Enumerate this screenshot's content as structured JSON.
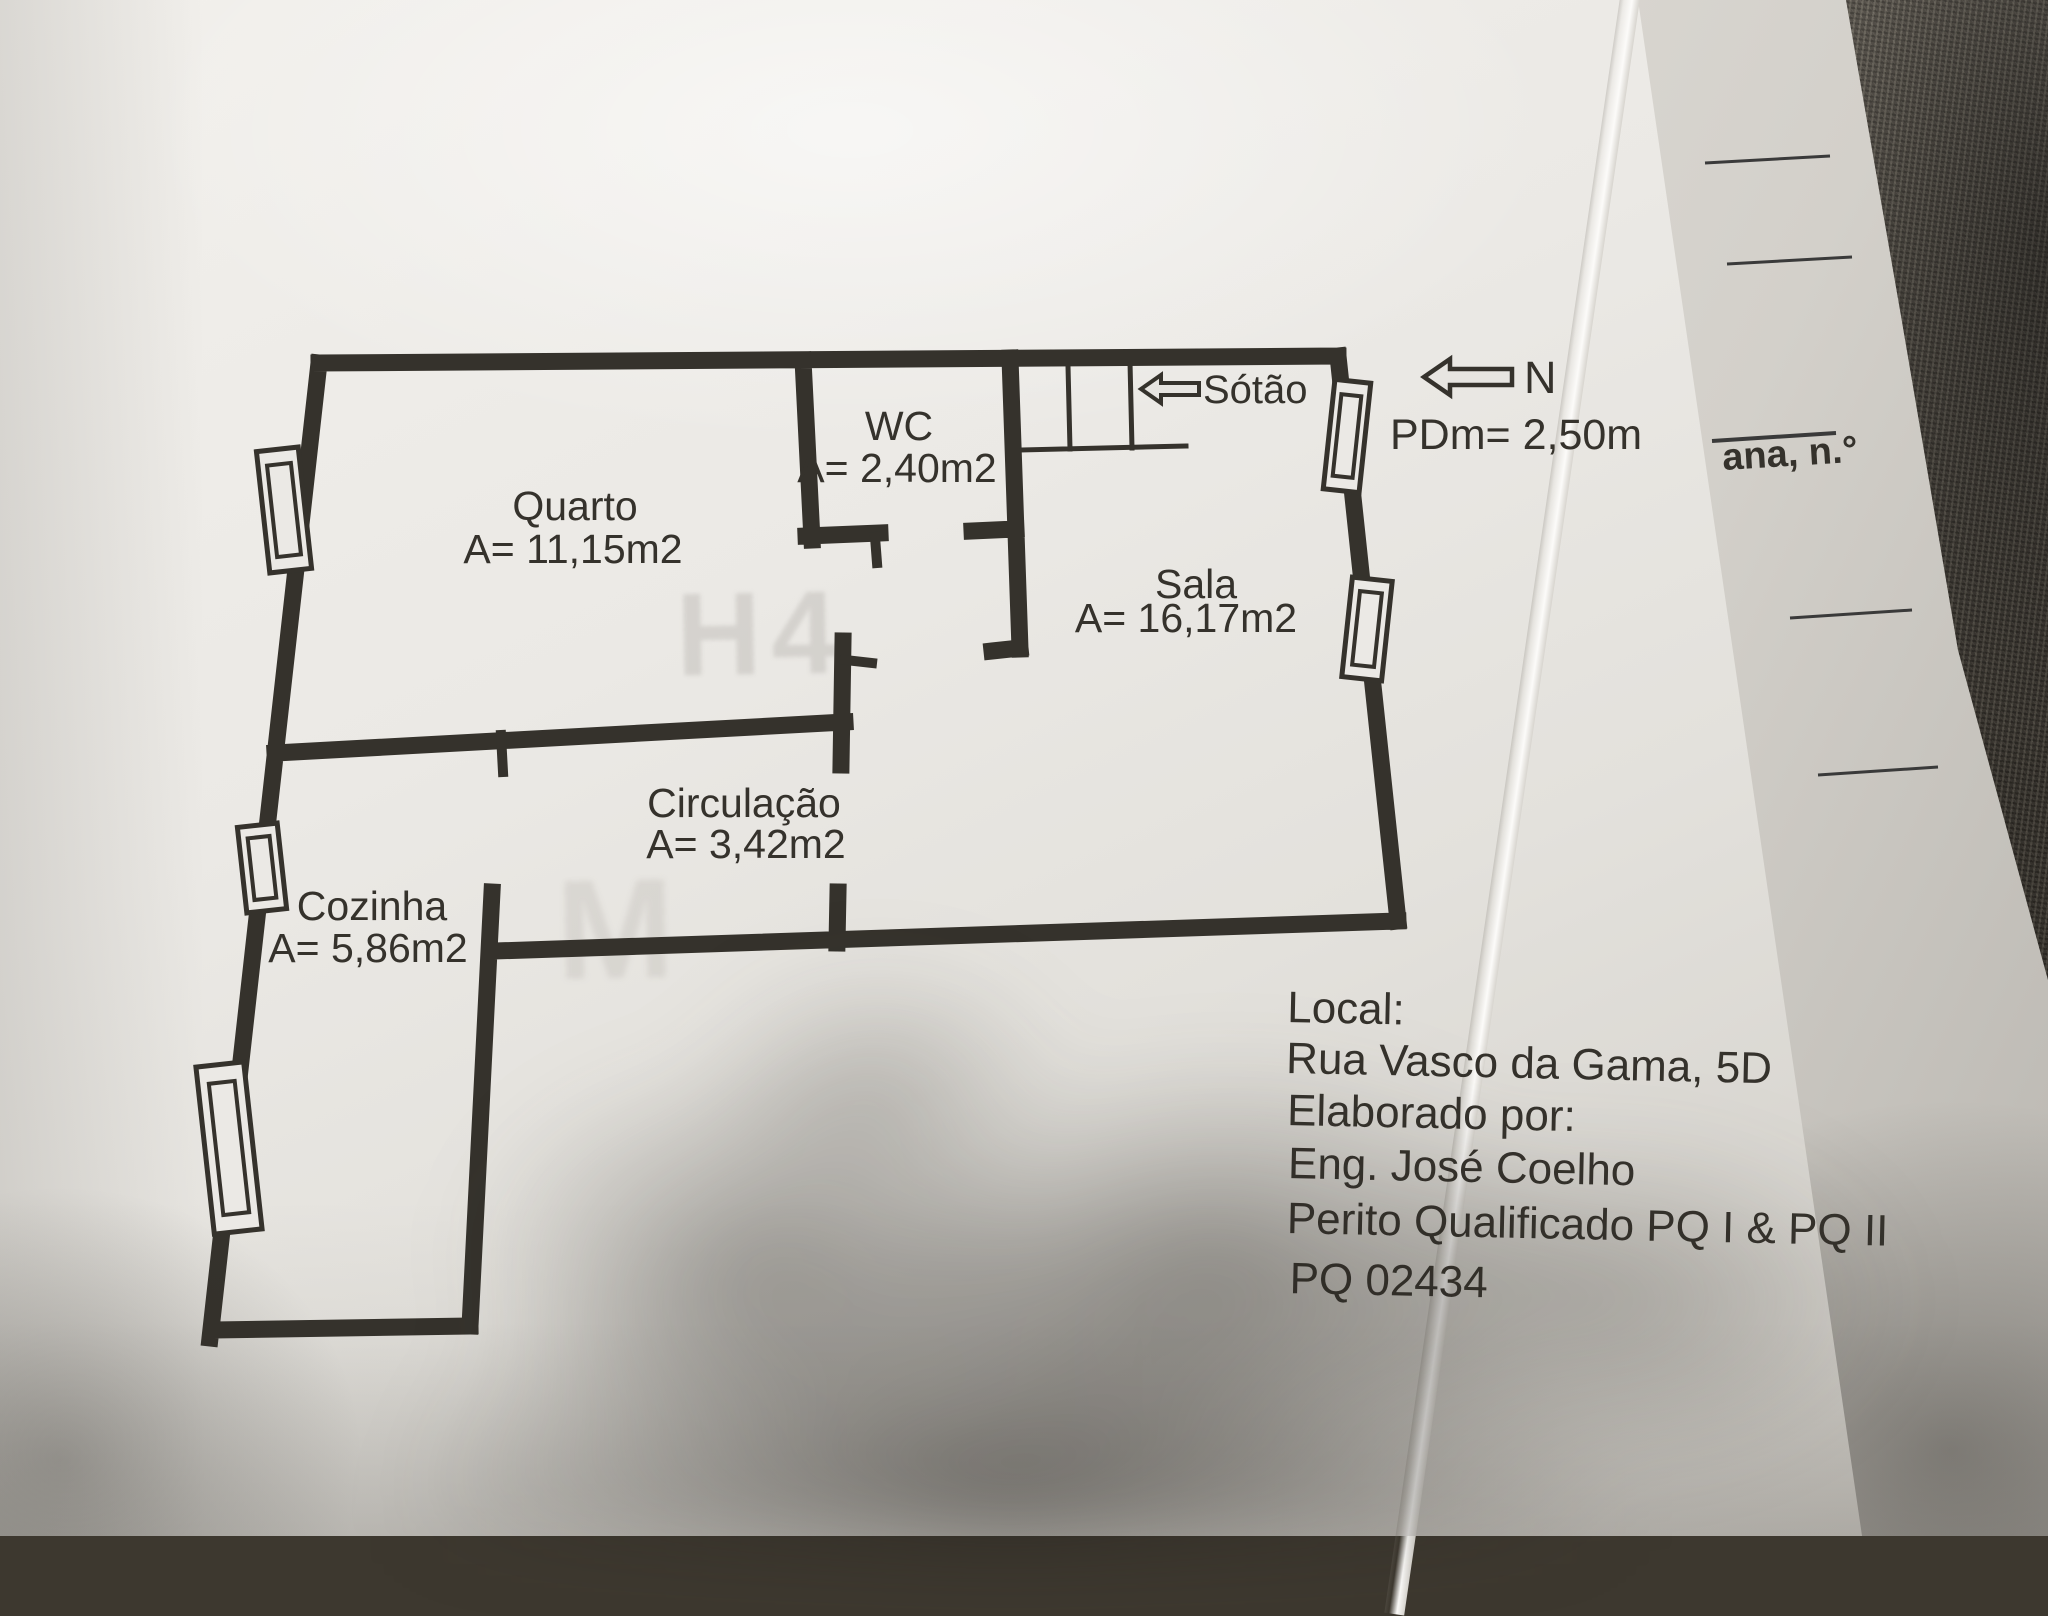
{
  "plan": {
    "rooms": {
      "quarto": {
        "name": "Quarto",
        "area": "A= 11,15m2"
      },
      "wc": {
        "name": "WC",
        "area": "A= 2,40m2"
      },
      "sala": {
        "name": "Sala",
        "area": "A= 16,17m2"
      },
      "circulacao": {
        "name": "Circulação",
        "area": "A= 3,42m2"
      },
      "cozinha": {
        "name": "Cozinha",
        "area": "A= 5,86m2"
      }
    },
    "annotations": {
      "attic": "Sótão",
      "north": "N",
      "ceiling_height": "PDm= 2,50m"
    }
  },
  "info_block": {
    "local_label": "Local:",
    "address": "Rua Vasco da Gama, 5D",
    "elaborated_label": "Elaborado por:",
    "engineer": "Eng. José Coelho",
    "credentials": "Perito Qualificado PQ I & PQ II",
    "license_number": "PQ 02434"
  },
  "side_sheet": {
    "visible_fragment": "ana, n.°"
  },
  "watermark": {
    "line1": "H4",
    "line2": "M"
  },
  "colors": {
    "paper": "#eae8e4",
    "ink": "#35322c",
    "fabric": "#46413a"
  }
}
